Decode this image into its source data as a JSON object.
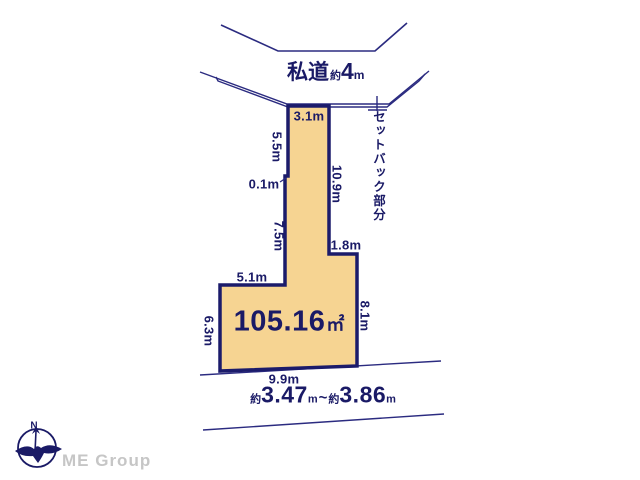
{
  "diagram": {
    "road": {
      "name": "私道",
      "approx": "約",
      "width": "4",
      "unit": "m"
    },
    "setback_label": "セットバック部分",
    "area": {
      "value": "105.16",
      "unit": "㎡"
    },
    "dimensions": {
      "top": "3.1m",
      "upper_left": "5.5m",
      "notch": "0.1m",
      "mid_left": "7.5m",
      "right_upper": "10.9m",
      "step": "1.8m",
      "shelf": "5.1m",
      "lower_left": "6.3m",
      "right_lower": "8.1m",
      "bottom": "9.9m"
    },
    "frontage": {
      "approx1": "約",
      "value1": "3.47",
      "unit1": "m",
      "separator": "~",
      "approx2": "約",
      "value2": "3.86",
      "unit2": "m"
    }
  },
  "footer": {
    "compass_north": "N",
    "brand": "ME Group"
  },
  "colors": {
    "plot_fill": "#f6d492",
    "plot_border": "#1b1b6b",
    "line_navy": "#2b2b80",
    "text_navy": "#1a1a66",
    "brand_gray": "#c6c6c6"
  }
}
